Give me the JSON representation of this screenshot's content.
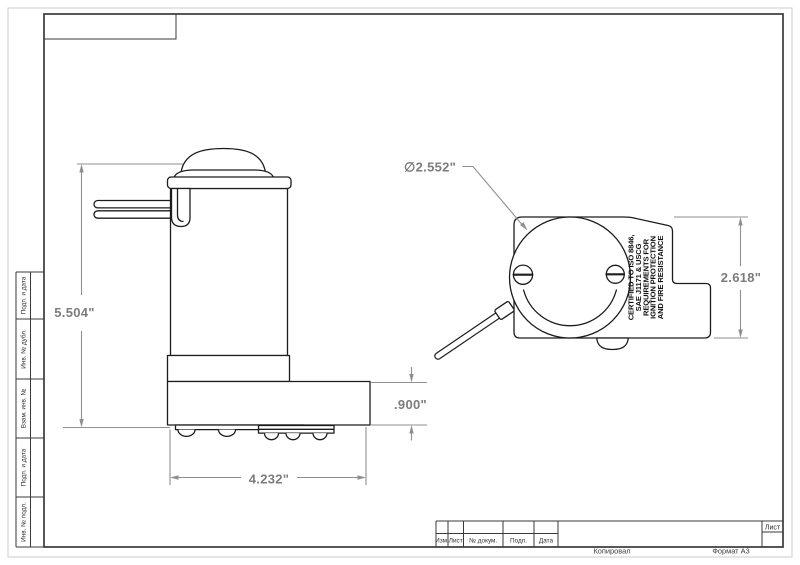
{
  "sheet": {
    "stamp_left_labels": [
      "Подп. и дата",
      "Инв. № дубл.",
      "Взам. инв. №",
      "Подп. и дата",
      "Инв. № подл."
    ],
    "title_block": {
      "col_izm": "Изм.",
      "col_list": "Лист",
      "col_docnum": "№ докум.",
      "col_podp": "Подп.",
      "col_data": "Дата",
      "sheet_label": "Лист"
    },
    "footer_copied": "Копировал",
    "footer_format": "Формат А3"
  },
  "views": {
    "cert_lines": [
      "CERTIFIED TO ISO 8846,",
      "SAE J1171 & USCG",
      "REQUIREMENTS FOR",
      "IGNITION PROTECTION",
      "AND FIRE RESISTANCE"
    ]
  },
  "dimensions": {
    "total_height": "5.504\"",
    "base_width": "4.232\"",
    "base_height": ".900\"",
    "head_diameter": "∅2.552\"",
    "end_height": "2.618\""
  },
  "colors": {
    "line": "#1c1c1c",
    "dim": "#8f8f8f",
    "dim_text": "#7c7c7c",
    "frame": "#3a3a3a"
  }
}
